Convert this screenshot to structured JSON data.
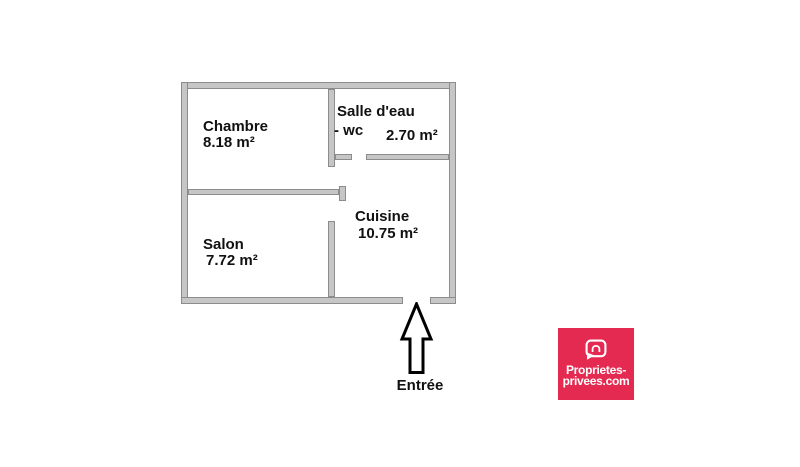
{
  "floorplan": {
    "rooms": [
      {
        "name": "Chambre",
        "area": "8.18 m²"
      },
      {
        "name": "Salle d'eau",
        "sub": "-  wc",
        "area": "2.70 m²"
      },
      {
        "name": "Cuisine",
        "area": "10.75 m²"
      },
      {
        "name": "Salon",
        "area": "7.72 m²"
      }
    ],
    "entrance": {
      "label": "Entrée",
      "icon": "up-arrow-icon"
    }
  },
  "logo": {
    "line1": "Proprietes-",
    "line2": "privees.com",
    "icon": "speech-bubble-house-icon"
  },
  "colors": {
    "background": "#ffffff",
    "wall_fill": "#c6c6c6",
    "wall_border": "#8c8c8c",
    "text": "#111111",
    "arrow_outline": "#000000",
    "logo_background": "#e52a51",
    "logo_text": "#ffffff"
  }
}
